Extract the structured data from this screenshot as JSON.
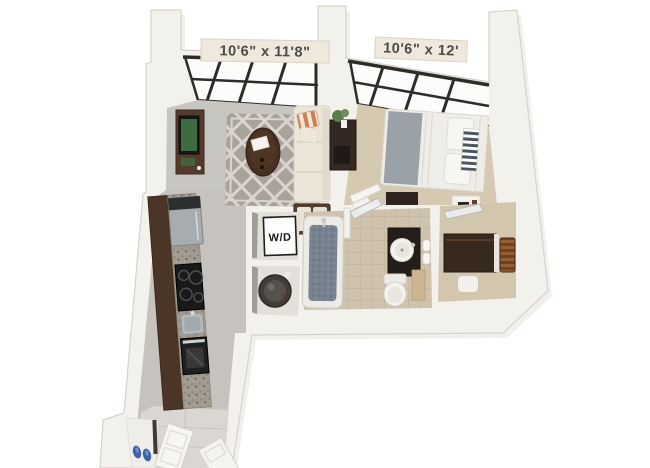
{
  "scene": {
    "type": "3d-floor-plan-rendering",
    "background": "#ffffff"
  },
  "rooms": [
    {
      "name": "living-room",
      "dimensions": "10'6\" x 11'8\""
    },
    {
      "name": "bedroom",
      "dimensions": "10'6\" x 12'"
    }
  ],
  "labels": {
    "washer_dryer": "W/D"
  },
  "colors": {
    "wall": "#f3f1ec",
    "wall_edge": "#d7d3ca",
    "wall_shadow": "#8f8c86",
    "window_frame": "#2e2c29",
    "living_floor": "#c8c6c1",
    "hall_floor": "#c6c3be",
    "entry_tile": "#dad7d2",
    "bedroom_carpet": "#d6c9b2",
    "closet_carpet": "#d3c6ae",
    "bath_tile": "#cfc3ae",
    "rug_base": "#a9a29b",
    "rug_pattern": "#dad5ce",
    "wood_dark": "#4a3527",
    "wood_console": "#543b2b",
    "sofa": "#ece6d8",
    "ottoman": "#55402e",
    "pillow_stripe_orange": "#cb8157",
    "bed_linen": "#efede7",
    "bed_blanket": "#9aa2a8",
    "pillow_stripe_navy": "#4a5663",
    "counter_granite": "#a19b90",
    "appliance_black": "#191919",
    "appliance_steel": "#a7acae",
    "water_heater": "#403d3a",
    "tub_water": "#76828f",
    "vanity_dark": "#251e18",
    "tv_screen": "#3f6b40",
    "plant_green": "#5d7c4b",
    "basket_brown": "#935f35",
    "shoes_blue": "#3c62a8",
    "label_bg": "#efe9dd",
    "label_text": "#4b4a46",
    "wd_box": "#fdfdfc",
    "wd_text": "#1a1a1a"
  }
}
